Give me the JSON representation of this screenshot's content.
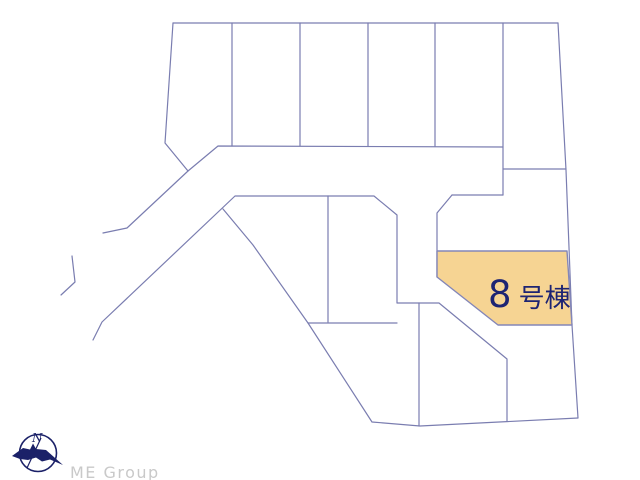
{
  "page": {
    "background": "#ffffff",
    "width": 640,
    "height": 480
  },
  "map": {
    "stroke_color": "#7a7db0",
    "stroke_width": 1.2,
    "segments": [
      [
        [
          173,
          23
        ],
        [
          558,
          23
        ]
      ],
      [
        [
          173,
          23
        ],
        [
          165,
          143
        ],
        [
          188,
          171
        ],
        [
          218,
          146
        ],
        [
          503,
          147
        ]
      ],
      [
        [
          232,
          23
        ],
        [
          232,
          146
        ]
      ],
      [
        [
          300,
          23
        ],
        [
          300,
          146
        ]
      ],
      [
        [
          368,
          23
        ],
        [
          368,
          146
        ]
      ],
      [
        [
          435,
          23
        ],
        [
          435,
          146
        ]
      ],
      [
        [
          503,
          23
        ],
        [
          503,
          195
        ]
      ],
      [
        [
          558,
          23
        ],
        [
          566,
          170
        ],
        [
          572,
          325
        ],
        [
          578,
          418
        ]
      ],
      [
        [
          503,
          169
        ],
        [
          566,
          169
        ]
      ],
      [
        [
          452,
          195
        ],
        [
          503,
          195
        ]
      ],
      [
        [
          452,
          195
        ],
        [
          437,
          213
        ],
        [
          437,
          277
        ]
      ],
      [
        [
          93,
          340
        ],
        [
          102,
          322
        ],
        [
          235,
          196
        ],
        [
          374,
          196
        ],
        [
          397,
          215
        ],
        [
          397,
          303
        ],
        [
          439,
          303
        ],
        [
          507,
          359
        ],
        [
          507,
          421
        ]
      ],
      [
        [
          188,
          171
        ],
        [
          127,
          228
        ],
        [
          103,
          233
        ]
      ],
      [
        [
          223,
          209
        ],
        [
          253,
          245
        ],
        [
          308,
          323
        ],
        [
          372,
          422
        ],
        [
          420,
          426
        ],
        [
          578,
          418
        ]
      ],
      [
        [
          308,
          323
        ],
        [
          397,
          323
        ]
      ],
      [
        [
          328,
          196
        ],
        [
          328,
          322
        ]
      ],
      [
        [
          419,
          303
        ],
        [
          419,
          426
        ]
      ],
      [
        [
          72,
          256
        ],
        [
          75,
          282
        ],
        [
          61,
          295
        ]
      ]
    ],
    "highlight_lot": {
      "label_number": "8",
      "label_suffix": "号棟",
      "fill": "#f6d493",
      "stroke": "#8386b8",
      "text_color": "#1d2473",
      "points": [
        [
          437,
          251
        ],
        [
          567,
          251
        ],
        [
          572,
          325
        ],
        [
          498,
          325
        ],
        [
          437,
          277
        ]
      ]
    }
  },
  "compass": {
    "north_label": "N",
    "color": "#1b2168"
  },
  "branding": {
    "logo_text": "ME Group",
    "text_color": "#c9c9c9"
  }
}
